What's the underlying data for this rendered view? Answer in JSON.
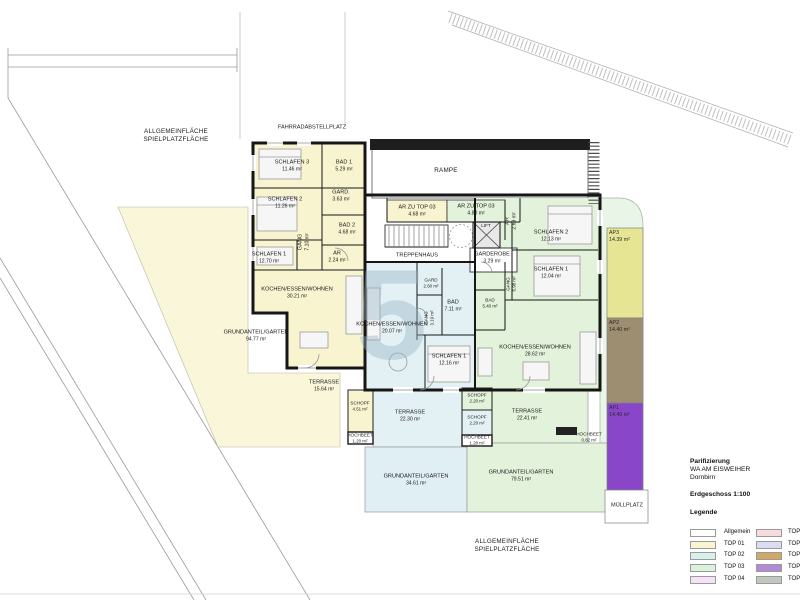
{
  "site": {
    "allgemein_top": {
      "line1": "ALLGEMEINFLÄCHE",
      "line2": "SPIELPLATZFLÄCHE"
    },
    "allgemein_bottom": {
      "line1": "ALLGEMEINFLÄCHE",
      "line2": "SPIELPLATZFLÄCHE"
    },
    "fahrradabstellplatz": "FAHRRADABSTELLPLATZ",
    "rampe": "RAMPE",
    "muellplatz": "MÜLLPLATZ",
    "watermark": "5"
  },
  "common": {
    "ar_zu_top03_a": {
      "name": "AR ZU TOP 03",
      "area": "4.68 m²"
    },
    "ar_zu_top03_b": {
      "name": "AR ZU TOP 03",
      "area": "4.80 m²"
    },
    "lift": "LIFT",
    "treppenhaus": "TREPPENHAUS",
    "garderobe": {
      "name": "GARDEROBE",
      "area": "3.29 m²"
    },
    "ar": {
      "name": "AR",
      "area": "2.69 m²"
    }
  },
  "top01": {
    "color": "#f8f4d0",
    "rooms": {
      "schlafen3": {
        "name": "SCHLAFEN 3",
        "area": "11.46 m²"
      },
      "bad1": {
        "name": "BAD 1",
        "area": "5.29 m²"
      },
      "schlafen2": {
        "name": "SCHLAFEN 2",
        "area": "11.26 m²"
      },
      "gard": {
        "name": "GARD.",
        "area": "3.63 m²"
      },
      "bad2": {
        "name": "BAD 2",
        "area": "4.68 m²"
      },
      "gang": {
        "name": "GANG",
        "area": "7.10 m²"
      },
      "schlafen1": {
        "name": "SCHLAFEN 1",
        "area": "12.70 m²"
      },
      "ar": {
        "name": "AR",
        "area": "2.24 m²"
      },
      "kochen": {
        "name": "KOCHEN/ESSEN/WOHNEN",
        "area": "30.21 m²"
      },
      "garten": {
        "name": "GRUNDANTEIL/GARTEN",
        "area": "94.77 m²"
      },
      "terrasse": {
        "name": "TERRASSE",
        "area": "15.64 m²"
      },
      "schopf": {
        "name": "SCHOPF",
        "area": "4.51 m²"
      },
      "hochbeet": {
        "name": "HOCHBEET",
        "area": "1.20 m²"
      }
    }
  },
  "top02": {
    "color": "#e4f1f4",
    "rooms": {
      "gard": {
        "name": "GARD",
        "area": "2.60 m²"
      },
      "bad": {
        "name": "BAD",
        "area": "7.11 m²"
      },
      "gang": {
        "name": "GANG",
        "area": "3.19 m²"
      },
      "kochen": {
        "name": "KOCHEN/ESSEN/WOHNEN",
        "area": "20.07 m²"
      },
      "schlafen1": {
        "name": "SCHLAFEN 1",
        "area": "12.16 m²"
      },
      "terrasse": {
        "name": "TERRASSE",
        "area": "22.30 m²"
      },
      "schopf": {
        "name": "SCHOPF",
        "area": "2.20 m²"
      },
      "hochbeet": {
        "name": "HOCHBEET",
        "area": "1.20 m²"
      },
      "garten": {
        "name": "GRUNDANTEIL/GARTEN",
        "area": "34.61 m²"
      }
    }
  },
  "top03": {
    "color": "#e3f2da",
    "rooms": {
      "schlafen2": {
        "name": "SCHLAFEN 2",
        "area": "12.13 m²"
      },
      "schlafen1": {
        "name": "SCHLAFEN 1",
        "area": "12.04 m²"
      },
      "gang": {
        "name": "GANG",
        "area": "6.98 m²"
      },
      "bad": {
        "name": "BAD",
        "area": "5.40 m²"
      },
      "kochen": {
        "name": "KOCHEN/ESSEN/WOHNEN",
        "area": "28.62 m²"
      },
      "schopf": {
        "name": "SCHOPF",
        "area": "2.20 m²"
      },
      "terrasse": {
        "name": "TERRASSE",
        "area": "22.41 m²"
      },
      "hochbeet": {
        "name": "HOCHBEET",
        "area": "0.82 m²"
      },
      "garten": {
        "name": "GRUNDANTEIL/GARTEN",
        "area": "79.51 m²"
      }
    }
  },
  "parking": {
    "ap3": {
      "name": "AP3",
      "area": "14.39 m²",
      "color": "#e6e593"
    },
    "ap2": {
      "name": "AP2",
      "area": "14.40 m²",
      "color": "#9d8d71"
    },
    "ap1": {
      "name": "AP1",
      "area": "14.40 m²",
      "color": "#8a46c8"
    }
  },
  "titleblock": {
    "project": "Parifizierung",
    "development": "WA  AM EISWEIHER",
    "city": "Dornbirn",
    "floor": "Erdgeschoss 1:100",
    "legend_title": "Legende"
  },
  "legend": {
    "left": [
      {
        "label": "Allgemein",
        "color": "#ffffff"
      },
      {
        "label": "TOP 01",
        "color": "#f8f5d0"
      },
      {
        "label": "TOP 02",
        "color": "#d9f1ed"
      },
      {
        "label": "TOP 03",
        "color": "#daf2d9"
      },
      {
        "label": "TOP 04",
        "color": "#f6e1f6"
      }
    ],
    "right": [
      {
        "label": "TOP 05",
        "color": "#f6dcdc"
      },
      {
        "label": "TOP 06",
        "color": "#dadcf2"
      },
      {
        "label": "TOP 07",
        "color": "#d3a766"
      },
      {
        "label": "TOP 08",
        "color": "#b28ad6"
      },
      {
        "label": "TOP 09",
        "color": "#c1c8bd"
      }
    ]
  }
}
